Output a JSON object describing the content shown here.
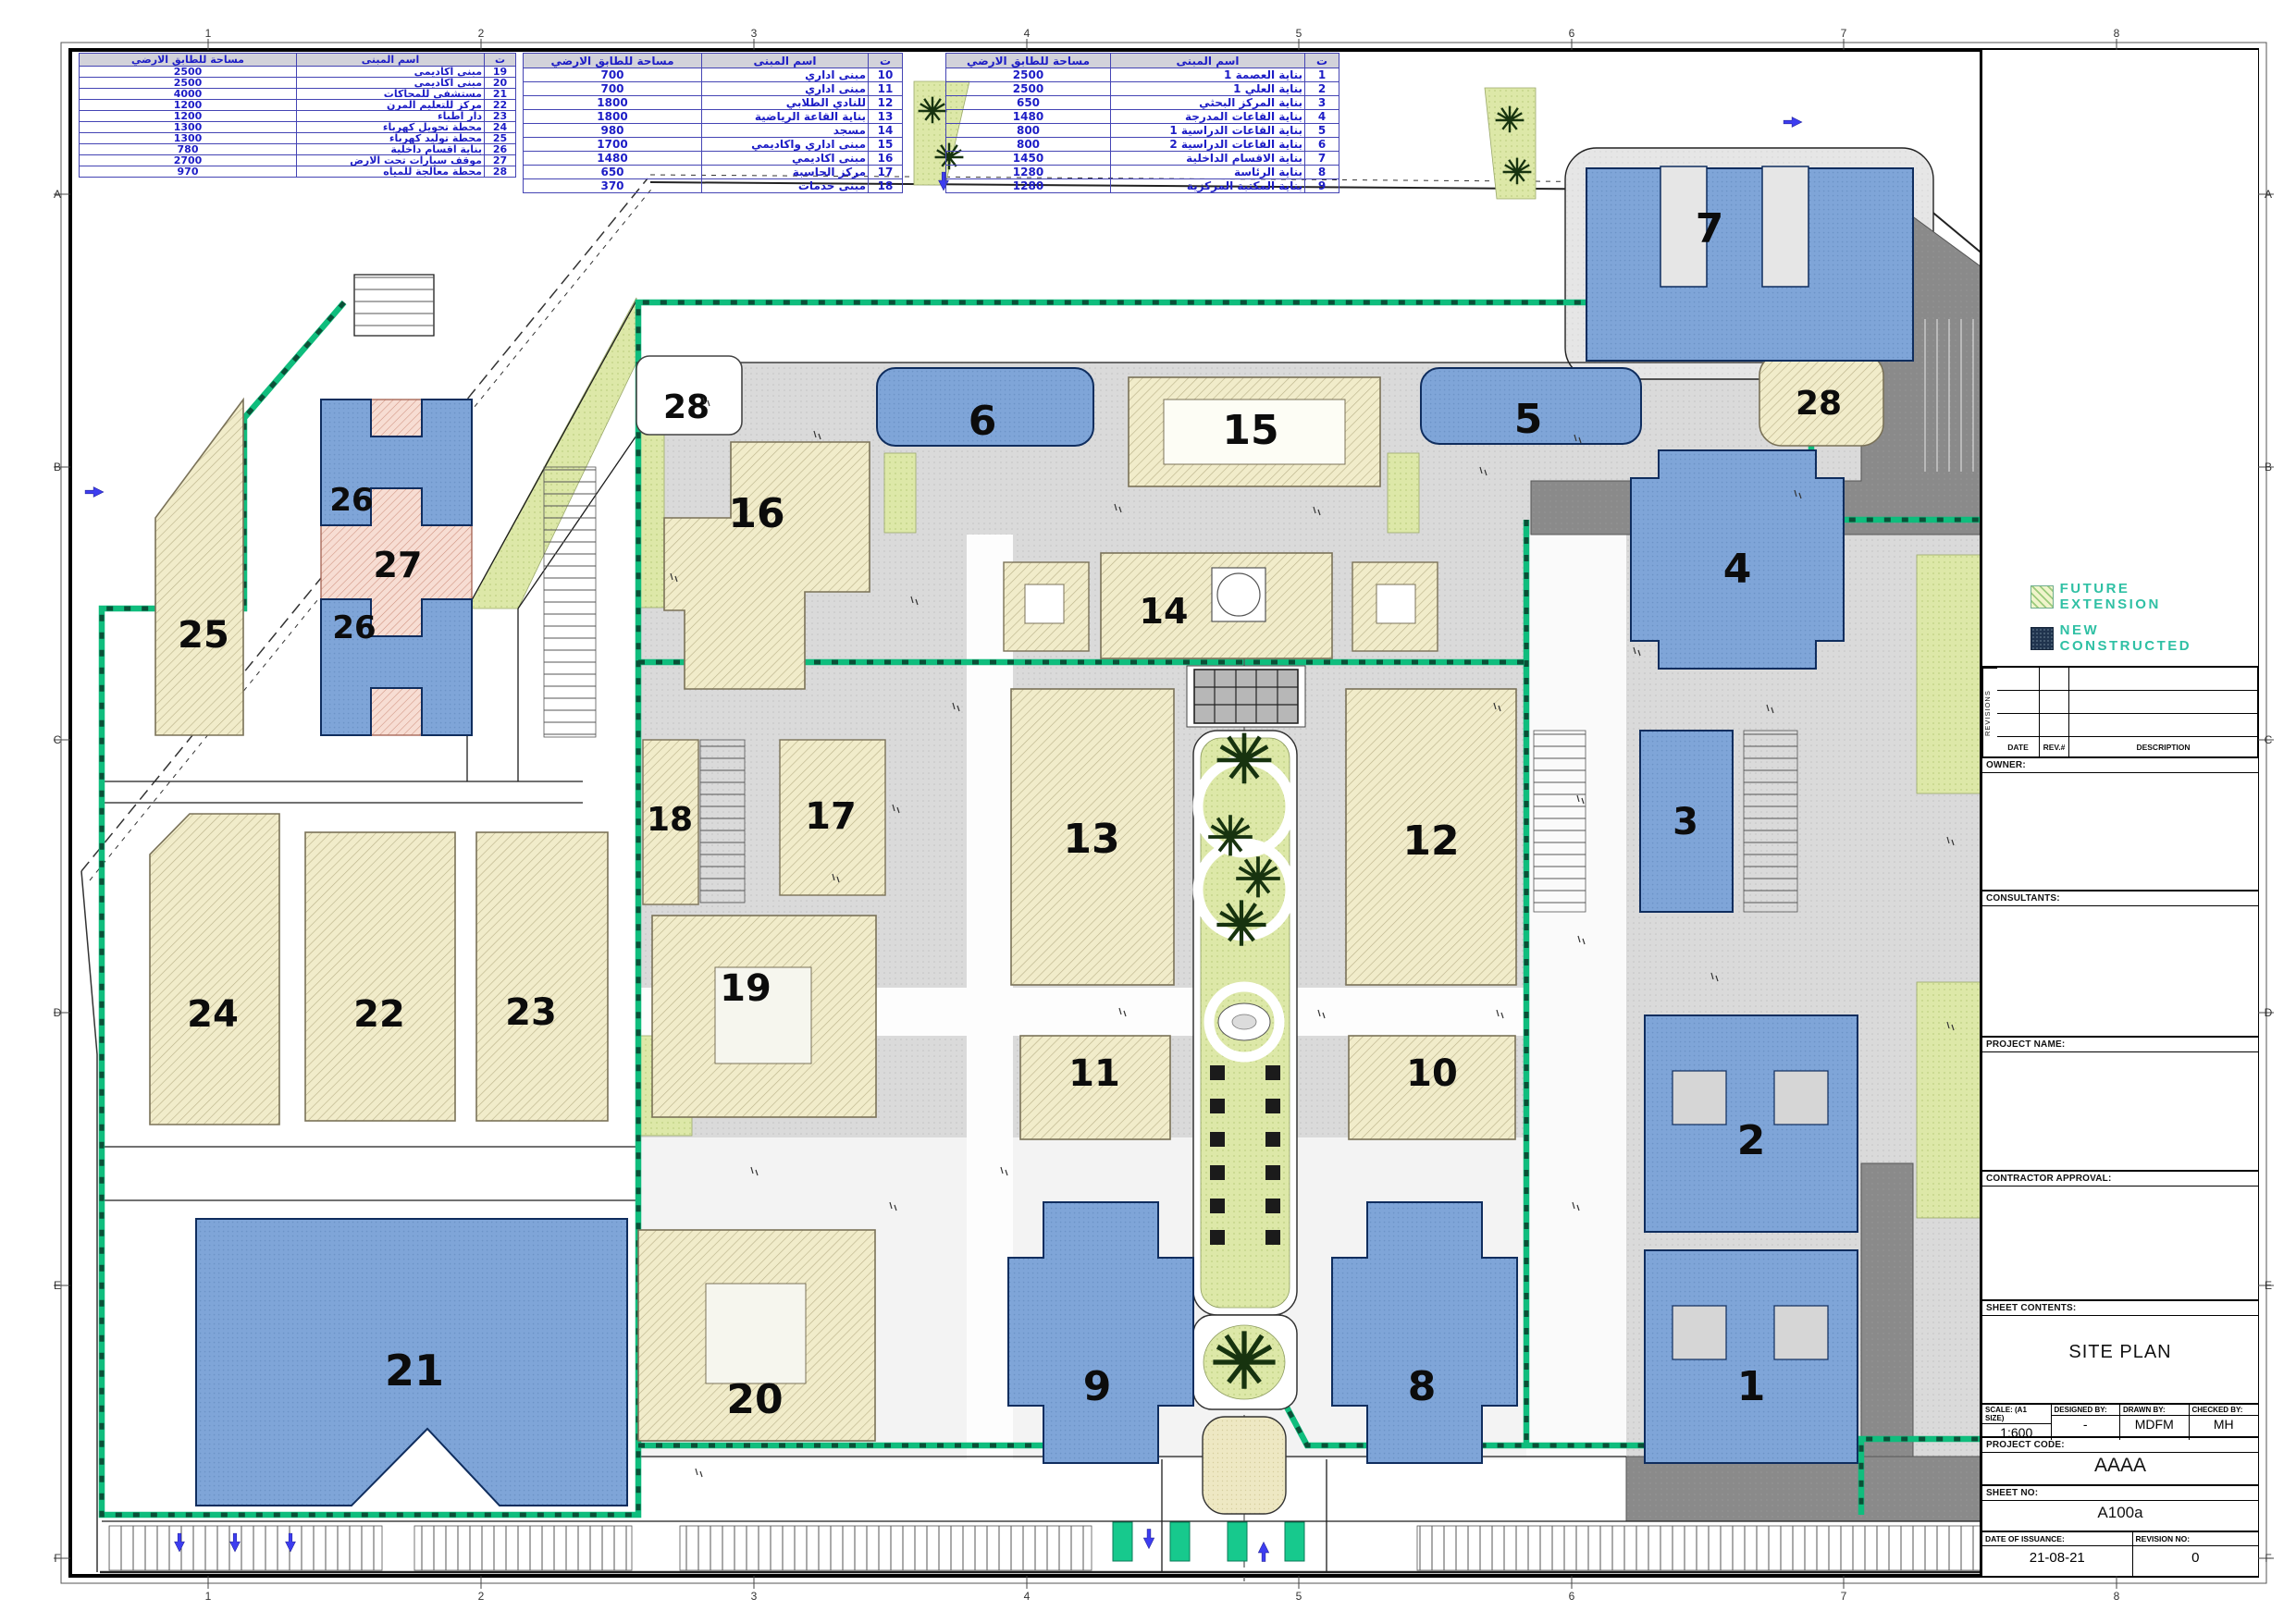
{
  "sheet": {
    "grid_cols": [
      "1",
      "2",
      "3",
      "4",
      "5",
      "6",
      "7",
      "8"
    ],
    "grid_rows": [
      "A",
      "B",
      "C",
      "D",
      "E",
      "F"
    ]
  },
  "tables": {
    "headers": {
      "area": "مساحة للطابق الارضي",
      "name": "اسم المبنى",
      "serial": "ت"
    },
    "t1": {
      "rows": [
        {
          "no": "19",
          "name": "مبنى اكاديمي",
          "area": "2500"
        },
        {
          "no": "20",
          "name": "مبنى اكاديمي",
          "area": "2500"
        },
        {
          "no": "21",
          "name": "مستشفى للمحاكات",
          "area": "4000"
        },
        {
          "no": "22",
          "name": "مركز للتعليم المرن",
          "area": "1200"
        },
        {
          "no": "23",
          "name": "دار اطباء",
          "area": "1200"
        },
        {
          "no": "24",
          "name": "محطة تحويل كهرباء",
          "area": "1300"
        },
        {
          "no": "25",
          "name": "محطة توليد كهرباء",
          "area": "1300"
        },
        {
          "no": "26",
          "name": "بناية اقسام داخلية",
          "area": "780"
        },
        {
          "no": "27",
          "name": "موقف سيارات تحت الارض",
          "area": "2700"
        },
        {
          "no": "28",
          "name": "محطة معالجة للمياه",
          "area": "970"
        }
      ]
    },
    "t2": {
      "rows": [
        {
          "no": "10",
          "name": "مبنى اداري",
          "area": "700"
        },
        {
          "no": "11",
          "name": "مبنى اداري",
          "area": "700"
        },
        {
          "no": "12",
          "name": "للنادي الطلابي",
          "area": "1800"
        },
        {
          "no": "13",
          "name": "بناية القاعة الرياضية",
          "area": "1800"
        },
        {
          "no": "14",
          "name": "مسجد",
          "area": "980"
        },
        {
          "no": "15",
          "name": "مبنى اداري واكاديمي",
          "area": "1700"
        },
        {
          "no": "16",
          "name": "مبنى اكاديمي",
          "area": "1480"
        },
        {
          "no": "17",
          "name": "مركز الحاسبة",
          "area": "650"
        },
        {
          "no": "18",
          "name": "مبنى خدمات",
          "area": "370"
        }
      ]
    },
    "t3": {
      "rows": [
        {
          "no": "1",
          "name": "بناية العصمة 1",
          "area": "2500"
        },
        {
          "no": "2",
          "name": "بناية العلي 1",
          "area": "2500"
        },
        {
          "no": "3",
          "name": "بناية المركز البحثي",
          "area": "650"
        },
        {
          "no": "4",
          "name": "بناية القاعات المدرجة",
          "area": "1480"
        },
        {
          "no": "5",
          "name": "بناية القاعات الدراسية 1",
          "area": "800"
        },
        {
          "no": "6",
          "name": "بناية القاعات الدراسية 2",
          "area": "800"
        },
        {
          "no": "7",
          "name": "بناية الاقسام الداخلية",
          "area": "1450"
        },
        {
          "no": "8",
          "name": "بناية الرئاسة",
          "area": "1280"
        },
        {
          "no": "9",
          "name": "بناية المكتبة المركزية",
          "area": "1280"
        }
      ]
    }
  },
  "legend": {
    "future_extension": "FUTURE EXTENSION",
    "new_constructed": "NEW CONSTRUCTED"
  },
  "title_block": {
    "revisions_label": "REVISIONS",
    "date_label": "DATE",
    "rev_label": "REV.#",
    "description_label": "DESCRIPTION",
    "owner_label": "OWNER:",
    "consultants_label": "CONSULTANTS:",
    "project_name_label": "PROJECT NAME:",
    "contractor_approval_label": "CONTRACTOR APPROVAL:",
    "sheet_contents_label": "SHEET CONTENTS:",
    "sheet_contents_value": "SITE PLAN",
    "scale_label": "SCALE: (A1 SIZE)",
    "scale_value": "1:600",
    "designed_by_label": "DESIGNED BY:",
    "designed_by_value": "-",
    "drawn_by_label": "DRAWN BY:",
    "drawn_by_value": "MDFM",
    "checked_by_label": "CHECKED BY:",
    "checked_by_value": "MH",
    "project_code_label": "PROJECT CODE:",
    "project_code_value": "AAAA",
    "sheet_no_label": "SHEET NO:",
    "sheet_no_value": "A100a",
    "date_of_issuance_label": "DATE OF ISSUANCE:",
    "date_of_issuance_value": "21-08-21",
    "revision_no_label": "REVISION NO:",
    "revision_no_value": "0"
  },
  "plan": {
    "buildings": [
      {
        "no": "28"
      },
      {
        "no": "6"
      },
      {
        "no": "15"
      },
      {
        "no": "5"
      },
      {
        "no": "28"
      },
      {
        "no": "7"
      },
      {
        "no": "16"
      },
      {
        "no": "4"
      },
      {
        "no": "14"
      },
      {
        "no": "13"
      },
      {
        "no": "12"
      },
      {
        "no": "3"
      },
      {
        "no": "18"
      },
      {
        "no": "17"
      },
      {
        "no": "19"
      },
      {
        "no": "11"
      },
      {
        "no": "10"
      },
      {
        "no": "2"
      },
      {
        "no": "20"
      },
      {
        "no": "9"
      },
      {
        "no": "8"
      },
      {
        "no": "1"
      },
      {
        "no": "21"
      },
      {
        "no": "22"
      },
      {
        "no": "23"
      },
      {
        "no": "24"
      },
      {
        "no": "25"
      },
      {
        "no": "26"
      },
      {
        "no": "27"
      },
      {
        "no": "26"
      }
    ]
  }
}
